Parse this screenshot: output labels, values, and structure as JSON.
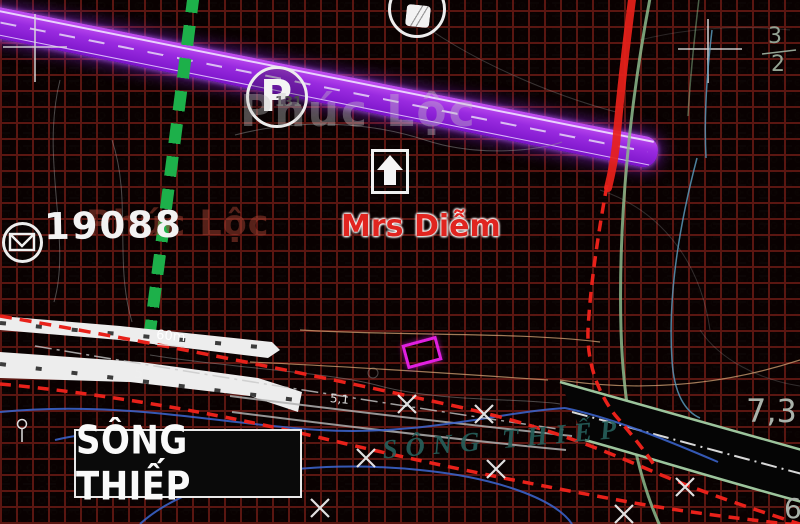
{
  "map": {
    "watermark": "Phúc Lộc",
    "plot_number": "19088",
    "owner_label": "Mrs Diễm",
    "river_box_label": "SÔNG THIẾP",
    "river_label": "SÔNG THIẾP",
    "road_width_label": "60m",
    "dim_label_5": "5",
    "dim_label_51": "5,1",
    "elevation_label_right": "7,3",
    "elevation_label_bottom_right": "6",
    "fraction_top": "3",
    "fraction_bottom": "2",
    "p_marker_label": "P",
    "p_marker_number": "131",
    "colors": {
      "planned_road_purple": "#9b2ce0",
      "boundary_red": "#e8211a",
      "utility_green_dashed": "#1db04a",
      "water_hatch_cyan": "#8fd8d8",
      "plot_highlight_magenta": "#e020e0",
      "hatch_pink": "#de846c",
      "contour_tan": "#c89a6e",
      "arc_green": "#8cba8c"
    }
  }
}
